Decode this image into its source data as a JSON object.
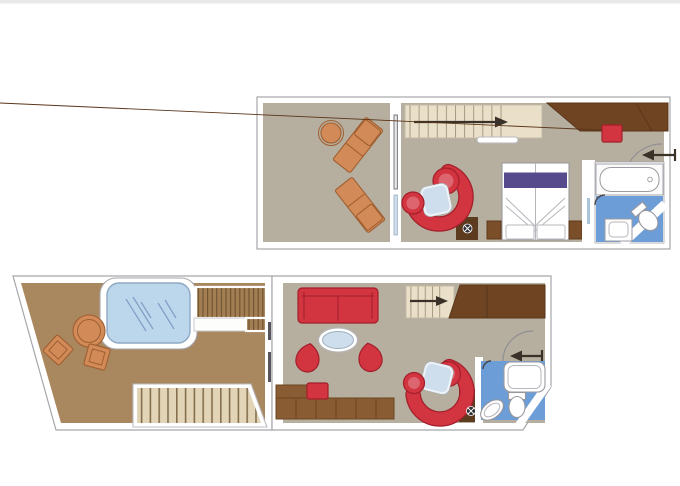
{
  "meta": {
    "title": "Duplex suite floor plan, two levels",
    "type": "architectural-floor-plan",
    "visible_text": "none"
  },
  "palette": {
    "pageBg": "#ffffff",
    "topBar": "#e8e9eb",
    "wallStroke": "#a6a6ac",
    "floorTaupe": "#b6ae9e",
    "floorBrown": "#a9875f",
    "stairCream": "#eae0ca",
    "stairSand": "#e2d4b6",
    "deckSlat": "#a27e52",
    "slatLine": "#6e5230",
    "red": "#d23440",
    "redDark": "#a21f2b",
    "redLight": "#dd6570",
    "orange": "#d18a58",
    "orangeDark": "#a05f30",
    "poolBlue": "#bcd6ec",
    "poolLine": "#7f9ec4",
    "bathBlue": "#6d9dd6",
    "bedPurple": "#574a8c",
    "tableBlue": "#cfdeed",
    "fixtureStroke": "#97979d",
    "wood": "#8a5c33",
    "woodDark": "#6f4423",
    "nightstand": "#7a4e28",
    "matBrown": "#5d3b1e",
    "arrowDark": "#3a3128"
  },
  "upper_deck": {
    "name": "Upper deck plan",
    "rooms": [
      "balcony",
      "staircase-landing",
      "sitting-corner",
      "bedroom",
      "bathroom",
      "entrance"
    ],
    "furniture": [
      "round-table",
      "sun-lounger",
      "sun-lounger",
      "curved-sofa",
      "round-chair",
      "coffee-table",
      "double-bed",
      "nightstand",
      "nightstand",
      "wardrobe",
      "stool",
      "bathtub",
      "sink",
      "toilet"
    ],
    "direction_arrows": [
      "stairs-up-right",
      "entrance-in-left"
    ]
  },
  "lower_deck": {
    "name": "Lower deck plan",
    "rooms": [
      "terrace",
      "whirlpool-deck",
      "living-room",
      "staircase",
      "bathroom",
      "entrance"
    ],
    "furniture": [
      "whirlpool-tub",
      "round-table",
      "terrace-chair",
      "terrace-chair",
      "deck-steps",
      "terrace-staircase",
      "sofa",
      "oval-table",
      "tulip-chair",
      "tulip-chair",
      "desk-sideboard",
      "stool",
      "curved-sofa",
      "round-chair",
      "coffee-table",
      "wardrobe",
      "shower",
      "toilet",
      "sink"
    ],
    "direction_arrows": [
      "stairs-up-right",
      "entrance-in-left"
    ]
  }
}
